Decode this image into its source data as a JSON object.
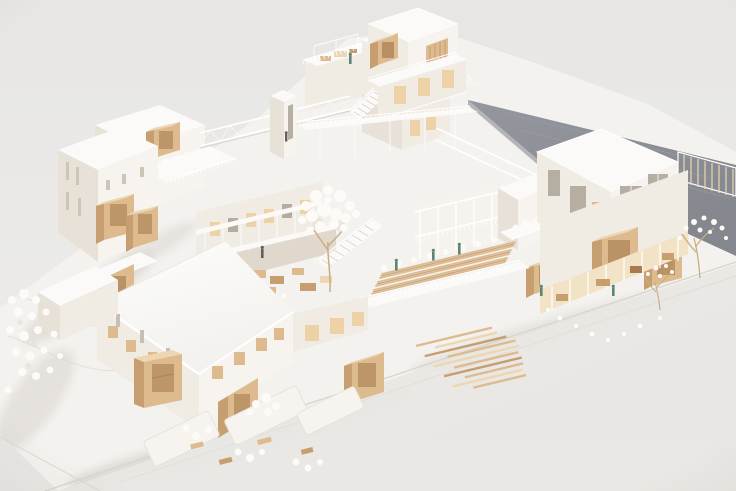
{
  "meta": {
    "title": "Architectural scale model — aerial view",
    "description": "Photograph of a white architectural scale model of a multi-building housing complex seen from above at an angle: white flat-roofed volumes with protruding wooden box windows, a central courtyard with a white tree, white exterior stairs and two lattice truss bridges linked by an elevator core, a large dark gray flat roof plane at the upper right, wooden deck planks, tiny green human figures, white model trees and shrubs on a pale gray base."
  },
  "palette": {
    "bg_top": "#e8e7e5",
    "bg_bottom": "#edebe9",
    "ground": "#f4f2ef",
    "street": "#e9e7e4",
    "shadow": "#c8c2ba",
    "roof_white": "#fbfaf8",
    "fascia": "#ffffff",
    "wall_lit": "#f7f4ef",
    "wall_mid": "#f0ebe3",
    "wall_shade": "#e7e1d8",
    "wall_dark": "#d9d2c6",
    "gray_roof": "#8b8e94",
    "gray_roof_dark": "#7b7e84",
    "gray_roof_light": "#9b9ea4",
    "wood": "#ddbb8f",
    "wood_light": "#edd7b2",
    "wood_dark": "#c79e70",
    "wood_deep": "#a67c50",
    "glass": "#b6aea2",
    "void": "#9a9184",
    "warm_void": "#ecd2a6",
    "warm_interior": "#f3e3c6",
    "arcade_shade": "#dcd4c7",
    "foliage": "#fcfbf8",
    "foliage_shade": "#e5dfd3",
    "figure_teal": "#5d8577",
    "figure_dark": "#63605a",
    "rail": "#ffffff",
    "line_soft": "#d9d4cc",
    "truss": "#f6f5f2",
    "trunk": "#c9ad82"
  }
}
